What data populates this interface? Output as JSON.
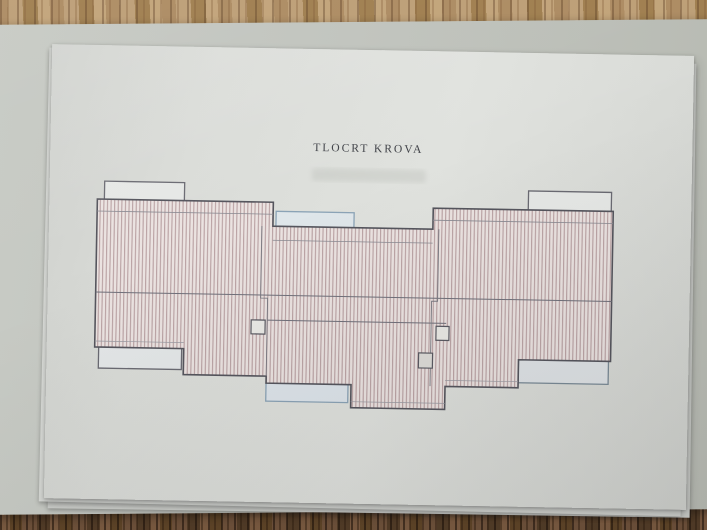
{
  "document": {
    "title": "TLOCRT KROVA"
  },
  "scene": {
    "paper_color": "#dcdeda",
    "desk_pad_color": "#c3c6c0",
    "wood_table_light_color": "#b3946c",
    "wood_table_dark_color": "#6b4e38",
    "roof_hatch_line_color": "#b49a9c",
    "roof_hatch_fill_color": "#ebe3e1",
    "roof_outline_color": "#55555d",
    "skylight_blue_color": "#8ba3b6",
    "canopy_fill_color": "#e6e8e6"
  }
}
